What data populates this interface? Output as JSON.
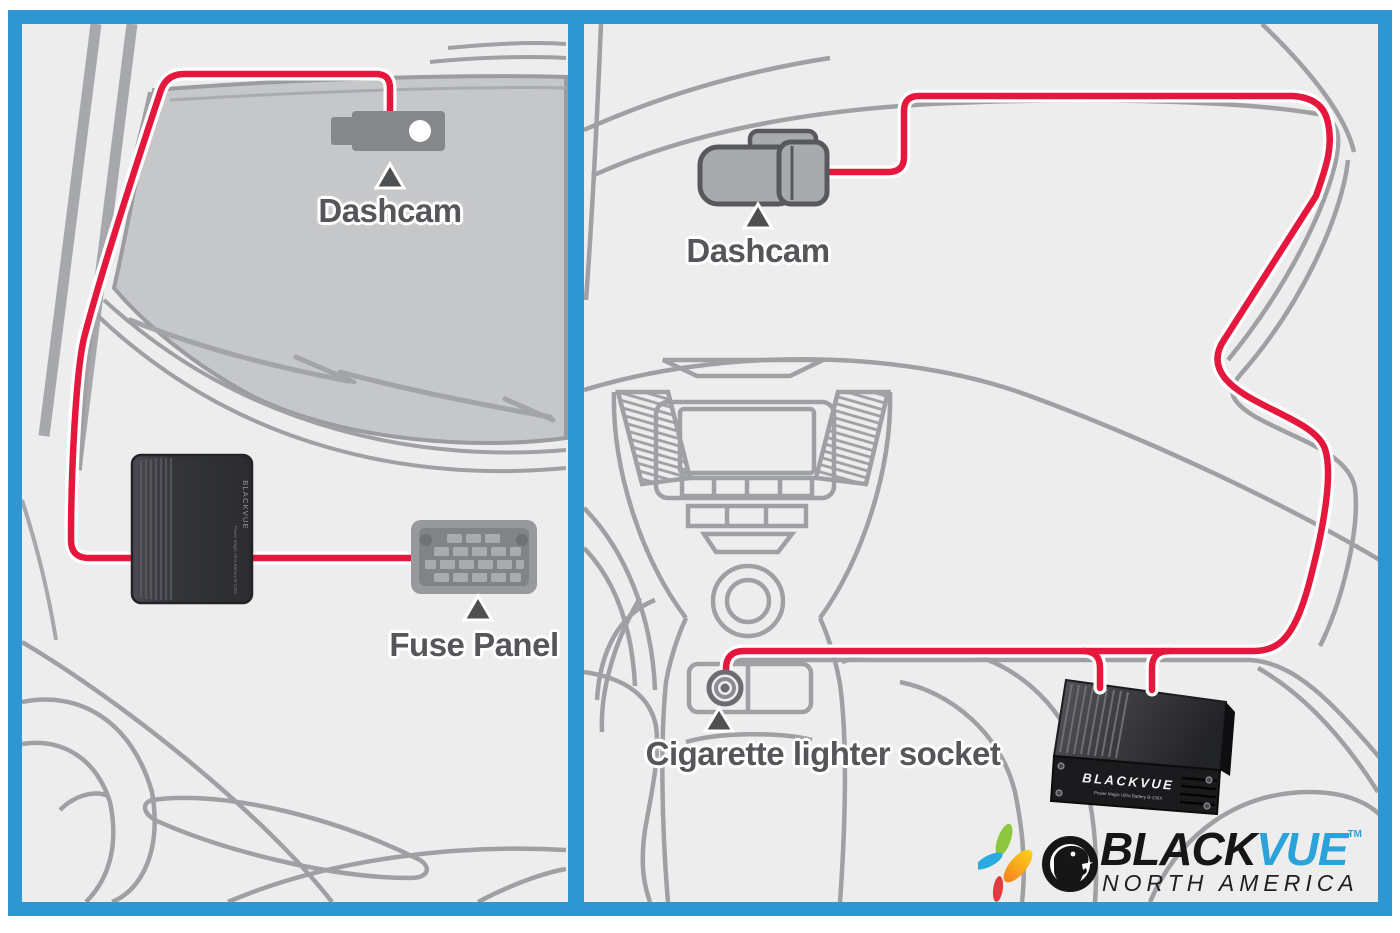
{
  "frame": {
    "border_color": "#2e96d1",
    "outer_background": "#ffffff",
    "panel_background": "#ededee"
  },
  "left_panel": {
    "dashcam_label": "Dashcam",
    "fuse_panel_label": "Fuse Panel"
  },
  "right_panel": {
    "dashcam_label": "Dashcam",
    "socket_label": "Cigarette lighter socket"
  },
  "battery": {
    "brand": "BLACKVUE",
    "model": "Power Magic Ultra Battery B-130X"
  },
  "logo": {
    "brand_black": "BLACK",
    "brand_vue": "VUE",
    "trademark": "TM",
    "subtitle": "NORTH AMERICA"
  },
  "colors": {
    "cable_red": "#e5173d",
    "cable_casing": "#ffffff",
    "sketch_gray": "#9ea0a3",
    "label_gray": "#55565a",
    "windshield_gray": "#c6c7c9",
    "device_gray": "#85878a",
    "frame_blue": "#2e96d1",
    "logo_vue_blue": "#2ba2da"
  }
}
